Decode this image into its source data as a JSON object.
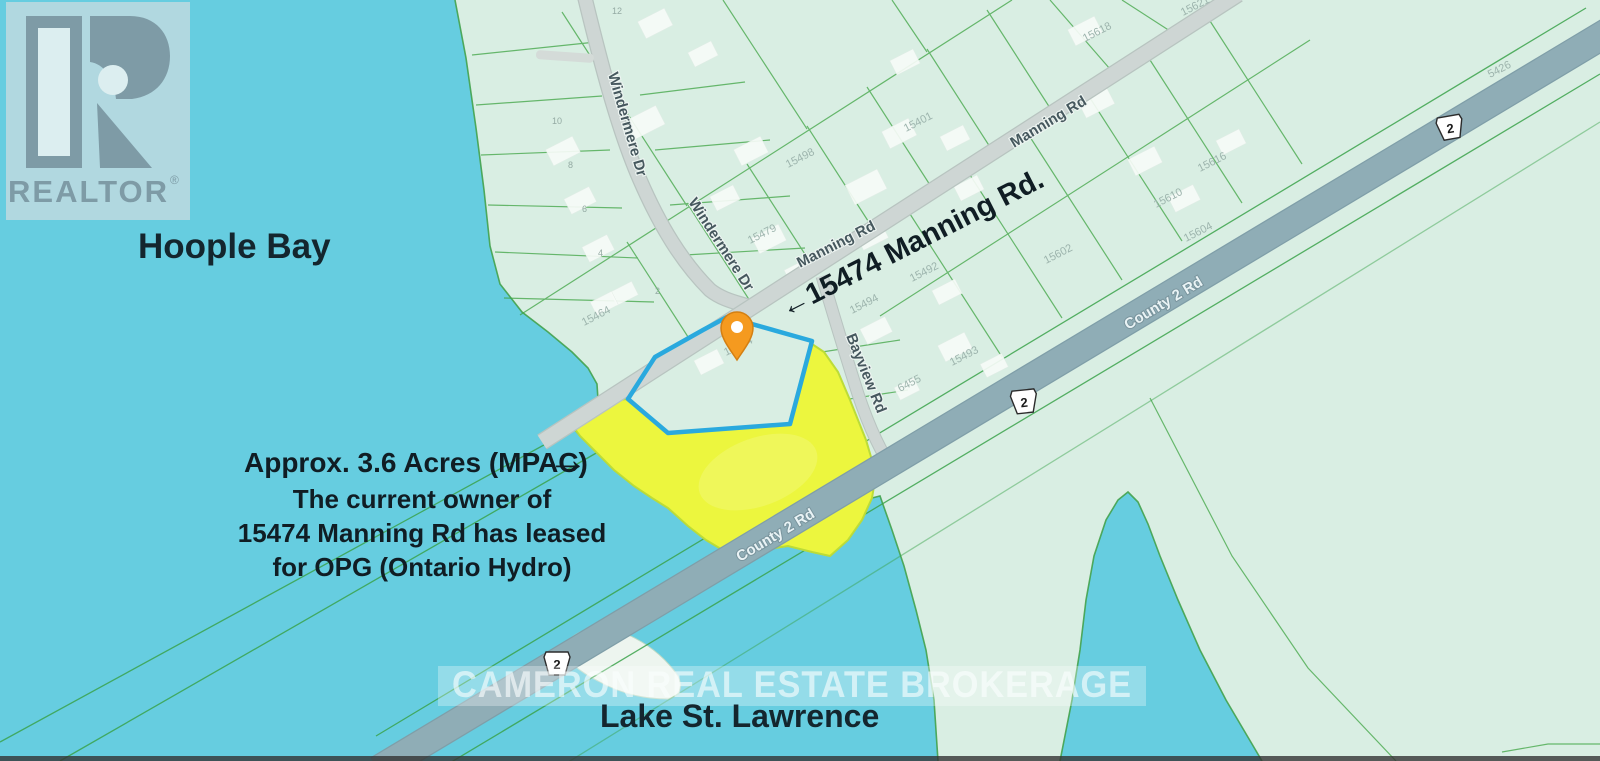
{
  "branding": {
    "realtor": "REALTOR",
    "reg": "®"
  },
  "labels": {
    "hoople_bay": "Hoople Bay",
    "lake": "Lake St. Lawrence",
    "watermark": "CAMERON REAL ESTATE BROKERAGE"
  },
  "roads": {
    "windermere_1": "Windermere Dr",
    "windermere_2": "Windermere Dr",
    "manning_1": "Manning Rd",
    "manning_2": "Manning Rd",
    "bayview": "Bayview Rd",
    "county_1": "County 2 Rd",
    "county_2": "County 2 Rd",
    "badge": "2"
  },
  "annotations": {
    "callout": "←15474 Manning Rd.",
    "acres": "Approx. 3.6 Acres (MPAC)",
    "arrow_right": "→",
    "owner1": "The current owner of",
    "owner2": "15474 Manning Rd has leased",
    "owner3": "for OPG (Ontario Hydro)"
  },
  "parcels": {
    "pin_parcel": "15474",
    "numbers": [
      "15621",
      "15618",
      "5426",
      "15401",
      "15498",
      "15616",
      "15610",
      "15604",
      "15602",
      "15479",
      "15464",
      "15494",
      "15492",
      "15493",
      "6455"
    ],
    "lot_digits": [
      "12",
      "10",
      "8",
      "6",
      "4",
      "2"
    ]
  },
  "colors": {
    "water": "#66cde0",
    "land": "#d9eee3",
    "shoreline": "#43a24c",
    "parcel_line": "#3fa443",
    "road_minor": "#ced6d4",
    "road_major": "#8fadb6",
    "highlight_yellow": "#ecf63e",
    "parcel_outline_blue": "#2aa9de",
    "pin_orange": "#f59a1f",
    "text_dark": "#14262e",
    "realtor_slate": "#7e9ba6",
    "realtor_bg": "#b7d9df"
  }
}
